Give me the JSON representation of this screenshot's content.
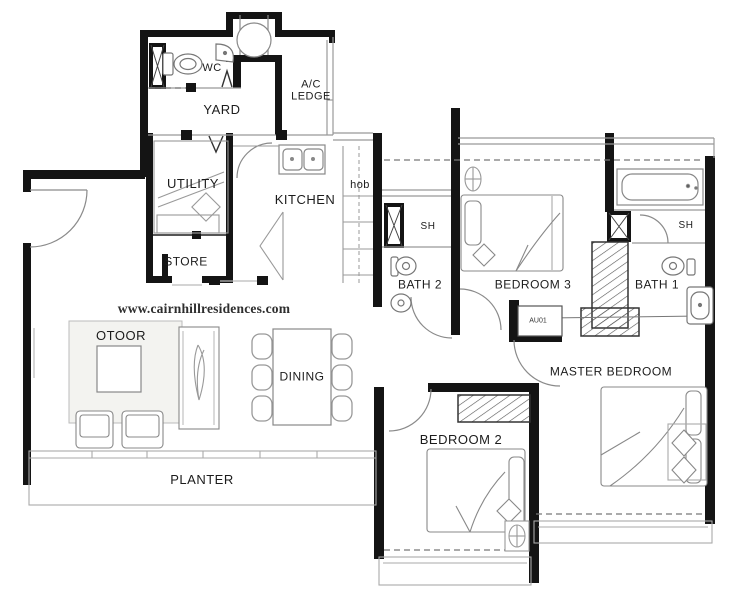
{
  "watermark": "www.cairnhillresidences.com",
  "plan": {
    "rooms": {
      "wc": "WC",
      "yard": "YARD",
      "ac_ledge": "A/C\nLEDGE",
      "utility": "UTILITY",
      "store": "STORE",
      "kitchen": "KITCHEN",
      "hob": "hob",
      "bath2_shower": "SH",
      "bath2": "BATH 2",
      "bedroom3": "BEDROOM 3",
      "bath1_shower": "SH",
      "bath1": "BATH 1",
      "master_bedroom": "MASTER BEDROOM",
      "bedroom2": "BEDROOM 2",
      "dining": "DINING",
      "living": "OTOOR",
      "planter": "PLANTER",
      "wardrobe_note": "AU01"
    }
  }
}
